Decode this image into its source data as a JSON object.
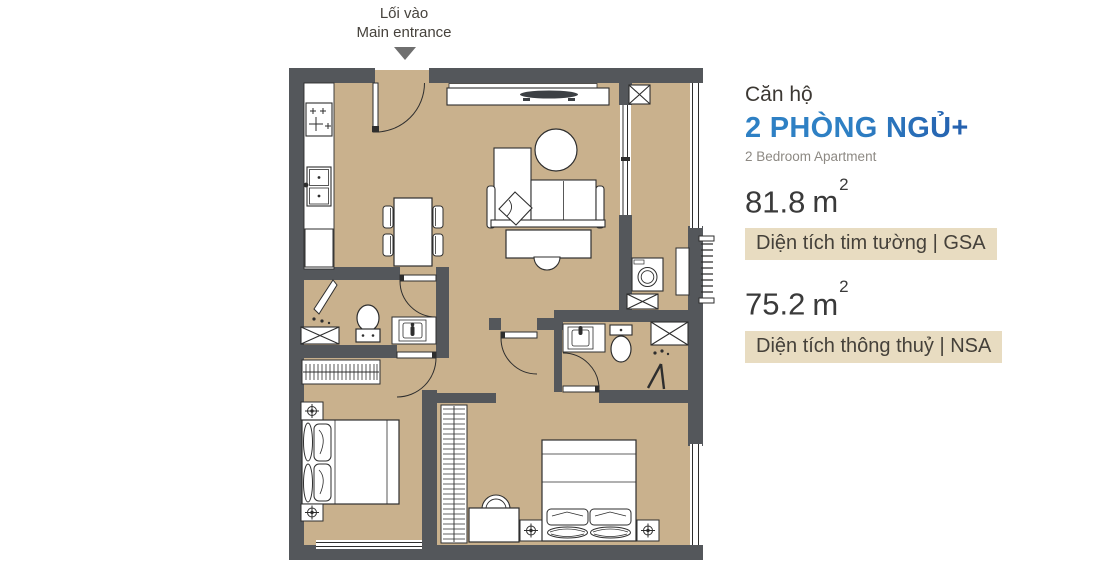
{
  "entrance": {
    "label_vi": "Lối vào",
    "label_en": "Main entrance"
  },
  "panel": {
    "category": "Căn hộ",
    "title": "2 PHÒNG NGỦ+",
    "subtitle": "2 Bedroom Apartment",
    "areas": [
      {
        "value": "81.8",
        "unit": "m",
        "sup": "2",
        "caption": "Diện tích tim tường | GSA"
      },
      {
        "value": "75.2",
        "unit": "m",
        "sup": "2",
        "caption": "Diện tích thông thuỷ | NSA"
      }
    ]
  },
  "colors": {
    "floor": "#c9b18d",
    "wall": "#54575b",
    "caption_bg": "#e8dcc1",
    "accent_blue_start": "#2e80c4",
    "accent_blue_end": "#1b3e97",
    "arrow_gray": "#6f6f6f",
    "text_dark": "#3c3833",
    "text_gray": "#8d8983"
  },
  "floorplan": {
    "fixture_icons": [
      "entrance-door",
      "stove",
      "kitchen-sink",
      "kitchen-cabinet",
      "dining-table",
      "dining-chair",
      "tv",
      "tv-console",
      "sofa",
      "throw-pillow",
      "round-side-table",
      "coffee-table",
      "ottoman",
      "balcony-sliding-door",
      "balcony-railing",
      "washing-machine",
      "drying-louver",
      "balcony-shelf",
      "service-shaft",
      "toilet",
      "vanity-sink",
      "shower-door",
      "shower-head",
      "wardrobe",
      "double-bed",
      "pillow",
      "nightstand",
      "ceiling-lamp",
      "desk",
      "desk-chair",
      "window"
    ]
  }
}
